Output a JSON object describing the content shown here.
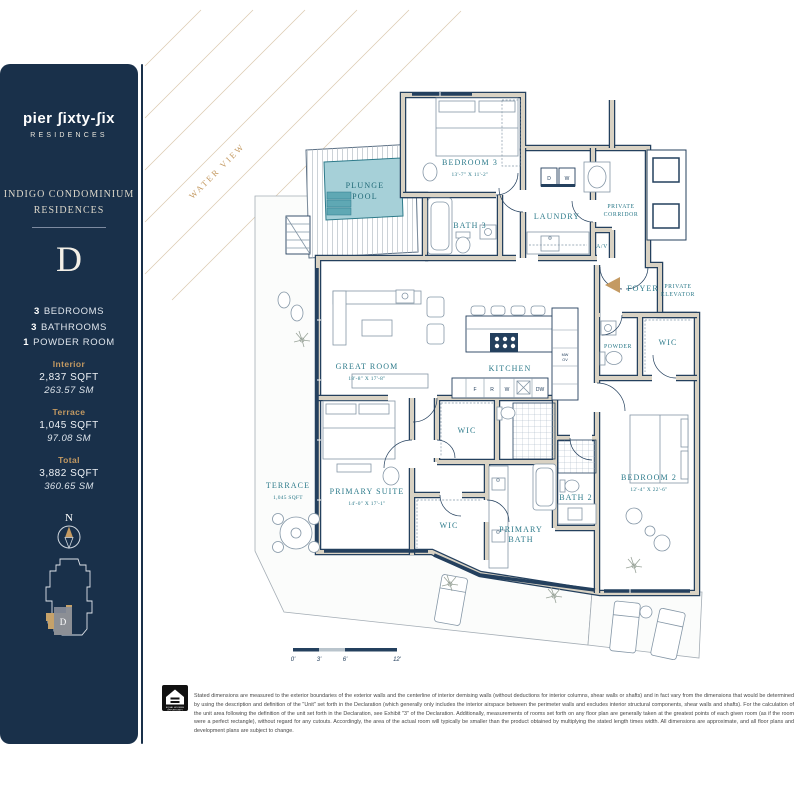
{
  "brand": {
    "logo": "pier ʃixty-ʃix",
    "sub": "RESIDENCES"
  },
  "sidebar": {
    "building_line1": "INDIGO CONDOMINIUM",
    "building_line2": "RESIDENCES",
    "unit": "D",
    "features": [
      {
        "num": "3",
        "label": "BEDROOMS"
      },
      {
        "num": "3",
        "label": "BATHROOMS"
      },
      {
        "num": "1",
        "label": "POWDER ROOM"
      }
    ],
    "areas": [
      {
        "label": "Interior",
        "sqft": "2,837 SQFT",
        "sm": "263.57 SM"
      },
      {
        "label": "Terrace",
        "sqft": "1,045 SQFT",
        "sm": "97.08 SM"
      },
      {
        "label": "Total",
        "sqft": "3,882 SQFT",
        "sm": "360.65 SM"
      }
    ],
    "compass_n": "N",
    "keyplan_unit": "D"
  },
  "plan": {
    "water_view": "WATER VIEW",
    "rooms": {
      "plunge1": "PLUNGE",
      "plunge2": "POOL",
      "bedroom3": "BEDROOM 3",
      "bedroom3_dim": "13'-7\" X 11'-2\"",
      "bath3": "BATH 3",
      "laundry": "LAUNDRY",
      "corridor1": "PRIVATE",
      "corridor2": "CORRIDOR",
      "av": "A/V",
      "foyer": "FOYER",
      "pelev1": "PRIVATE",
      "pelev2": "ELEVATOR",
      "great_room": "GREAT ROOM",
      "great_room_dim": "18'-8\" X 17'-8\"",
      "kitchen": "KITCHEN",
      "wic": "WIC",
      "powder": "POWDER",
      "primary_suite": "PRIMARY SUITE",
      "primary_suite_dim": "14'-0\" X 17'-1\"",
      "primary_bath1": "PRIMARY",
      "primary_bath2": "BATH",
      "bath2": "BATH 2",
      "bedroom2": "BEDROOM 2",
      "bedroom2_dim": "12'-4\" X 22'-6\"",
      "terrace": "TERRACE",
      "terrace_area": "1,045 SQFT"
    },
    "appliances": {
      "d": "D",
      "w": "W",
      "f": "F",
      "r": "R",
      "w2": "W",
      "dw": "DW",
      "mw": "MW",
      "ov": "OV"
    },
    "scale_ticks": [
      "0'",
      "3'",
      "6'",
      "12'"
    ]
  },
  "footer": {
    "equal_housing1": "EQUAL HOUSING",
    "equal_housing2": "OPPORTUNITY",
    "disclaimer": "Stated dimensions are measured to the exterior boundaries of the exterior walls and the centerline of interior demising walls (without deductions for interior columns, shear walls or shafts) and in fact vary from the dimensions that would be determined by using the description and definition of the \"Unit\" set forth in the Declaration (which generally only includes the interior airspace between the perimeter walls and excludes interior structural components, shear walls and shafts). For the calculation of the unit area following the definition of the unit set forth in the Declaration, see Exhibit \"3\" of the Declaration. Additionally, measurements of rooms set forth on any floor plan are generally taken at the greatest points of each given room (as if the room were a perfect rectangle), without regard for any cutouts. Accordingly, the area of the actual room will typically be smaller than the product obtained by multiplying the stated length times width. All dimensions are approximate, and all floor plans and development plans are subject to change."
  }
}
